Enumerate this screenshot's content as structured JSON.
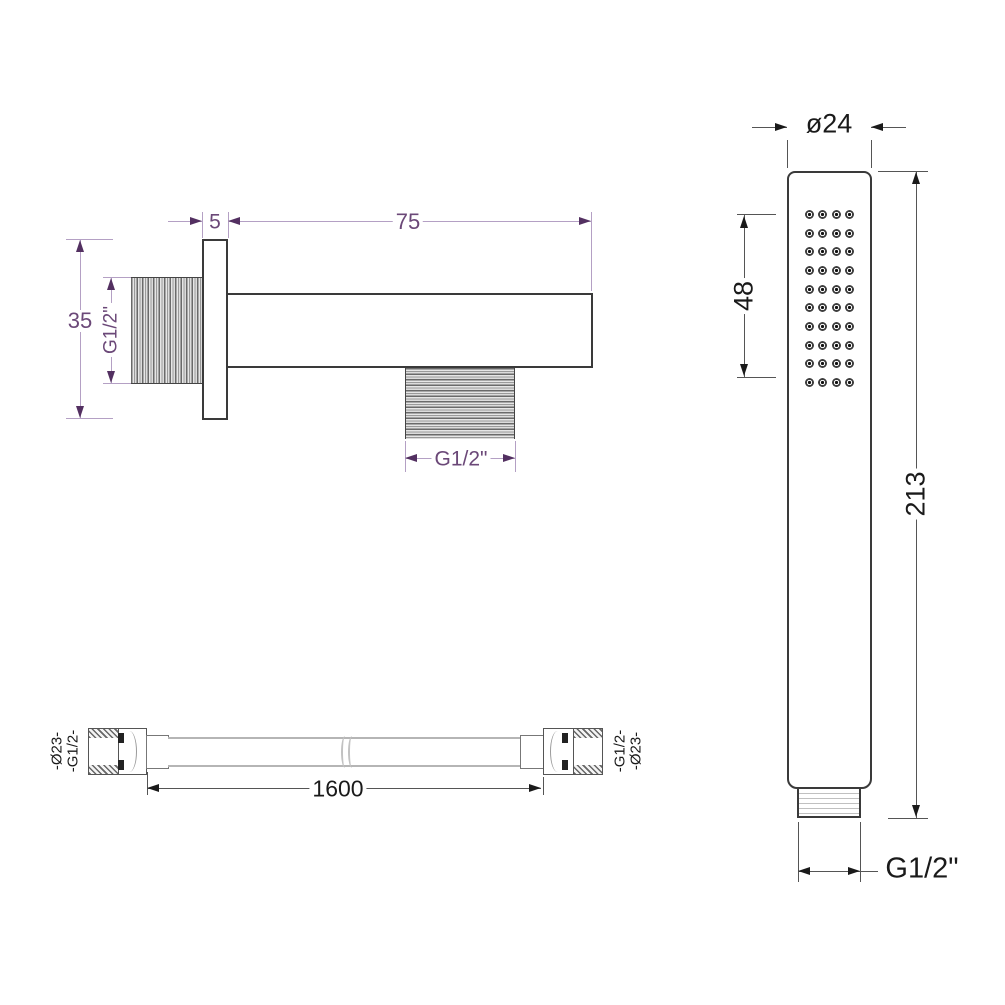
{
  "drawing": {
    "background": "#ffffff",
    "outline_color": "#3a3a3a",
    "hose_line_color": "#b5b5b5",
    "elbow_dim_text_color": "#6b4878",
    "elbow_dim_line_color": "#b4a0c4",
    "dark_dim_color": "#1a1a1a"
  },
  "wall_elbow": {
    "dim_flange_thickness": "5",
    "dim_arm_length": "75",
    "dim_flange_height": "35",
    "dim_inlet_thread": "G1/2\"",
    "dim_outlet_thread": "G1/2\""
  },
  "handset": {
    "dim_head_width": "ø24",
    "dim_spray_face_length": "48",
    "dim_total_length": "213",
    "dim_connector_thread": "G1/2\"",
    "nozzle_grid": {
      "rows": 10,
      "cols": 4
    }
  },
  "hose": {
    "dim_length": "1600",
    "left_end_label": {
      "outer": "-Ø23-",
      "inner": "-G1/2-"
    },
    "right_end_label": {
      "outer": "-G1/2-",
      "inner": "-Ø23-"
    }
  }
}
